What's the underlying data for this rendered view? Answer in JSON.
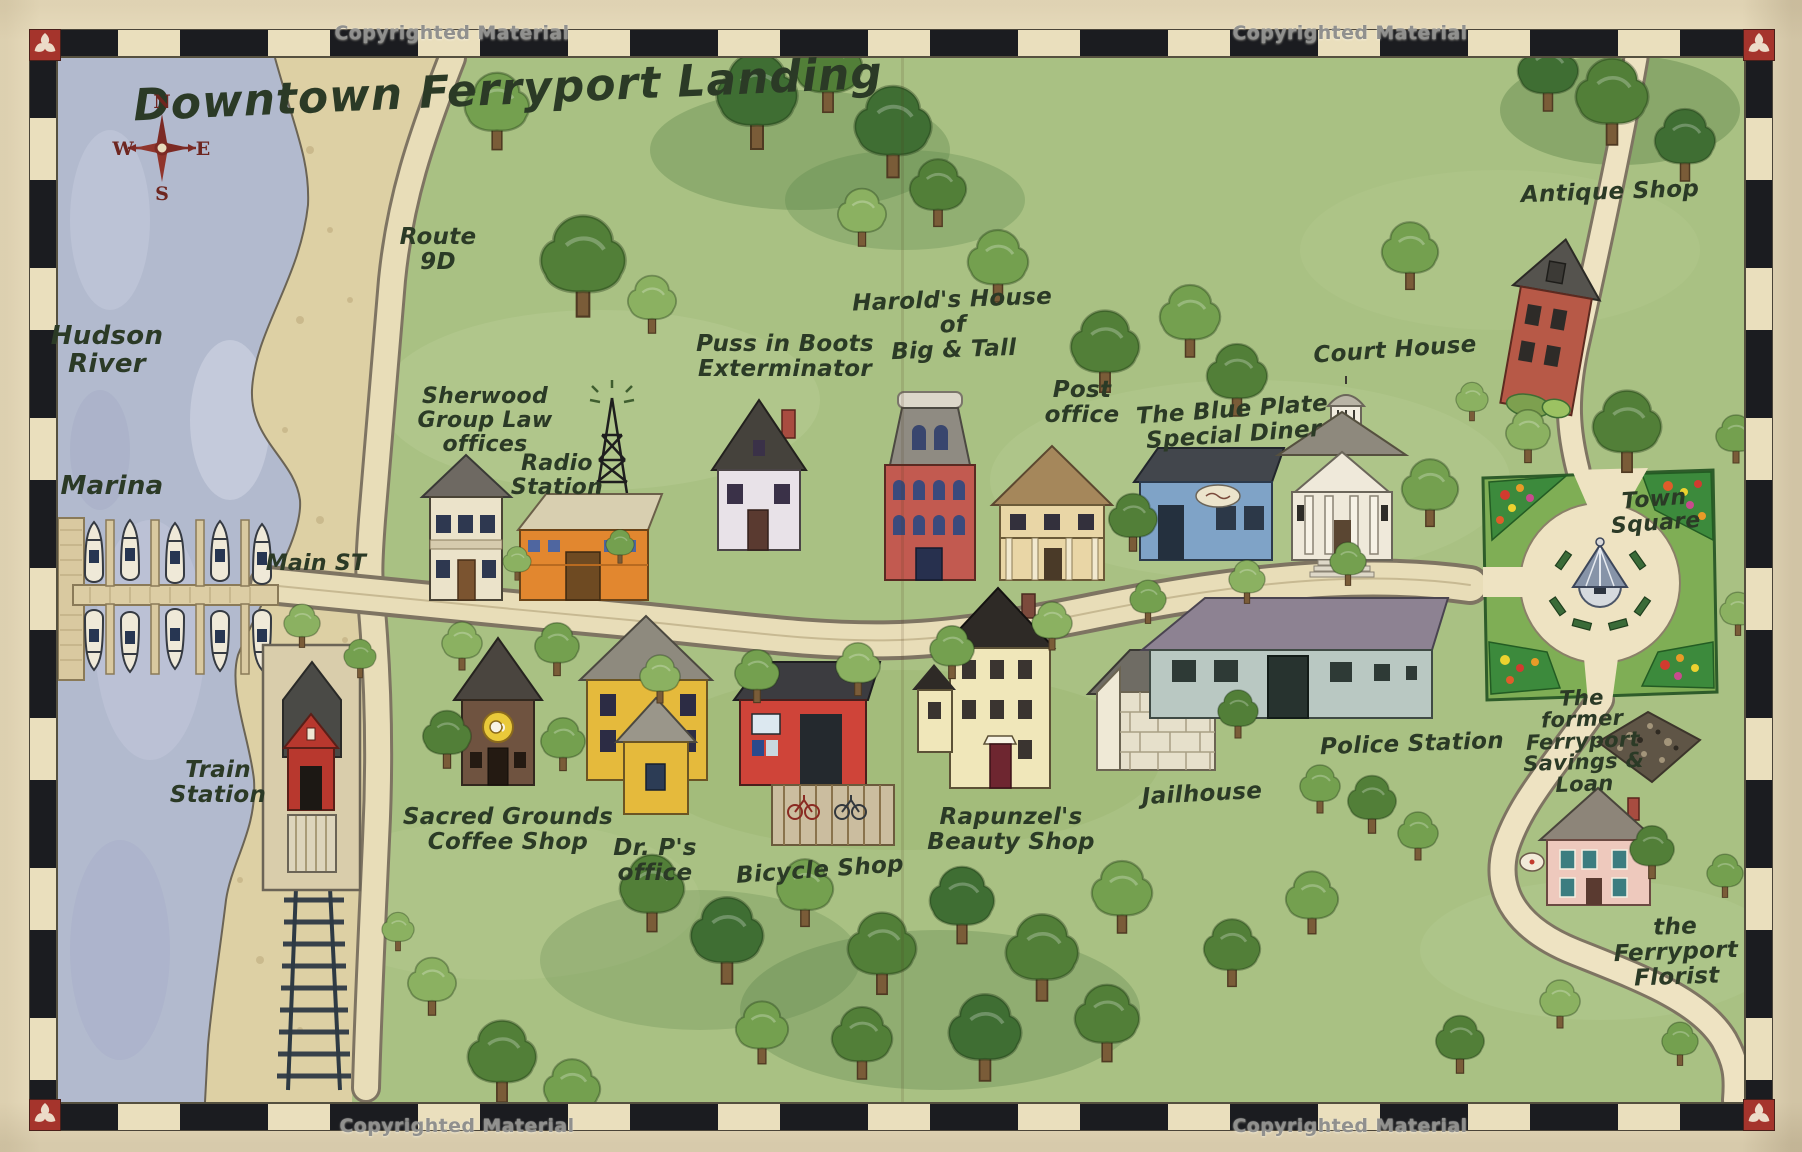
{
  "title": "Downtown Ferryport Landing",
  "copyright_text": "Copyrighted Material",
  "compass": {
    "n": "N",
    "e": "E",
    "s": "S",
    "w": "W"
  },
  "colors": {
    "paper": "#e8dcbd",
    "ink": "#2b3a26",
    "water": "#b2bace",
    "sand": "#ddd0a4",
    "grass": "#a9c183",
    "road": "#e8ddb8",
    "band_black": "#1b1c20",
    "corner_red": "#a5342c",
    "compass_red": "#6e2620"
  },
  "places": {
    "hudson_river": "Hudson\nRiver",
    "marina": "Marina",
    "main_st": "Main ST",
    "route_9d": "Route\n9D",
    "train_station": "Train\nStation",
    "sherwood": "Sherwood\nGroup Law\noffices",
    "radio_station": "Radio\nStation",
    "puss_in_boots": "Puss in Boots\nExterminator",
    "harolds": "Harold's House\nof\nBig & Tall",
    "post_office": "Post\noffice",
    "blue_plate": "The Blue Plate\nSpecial Diner",
    "court_house": "Court House",
    "antique_shop": "Antique Shop",
    "town_square": "Town Square",
    "police_station": "Police Station",
    "jailhouse": "Jailhouse",
    "rapunzels": "Rapunzel's\nBeauty Shop",
    "bicycle_shop": "Bicycle Shop",
    "dr_p": "Dr. P's\noffice",
    "sacred_grounds": "Sacred Grounds\nCoffee Shop",
    "savings_loan": "The\nformer\nFerryport\nSavings &\nLoan",
    "florist": "the Ferryport\nFlorist"
  }
}
